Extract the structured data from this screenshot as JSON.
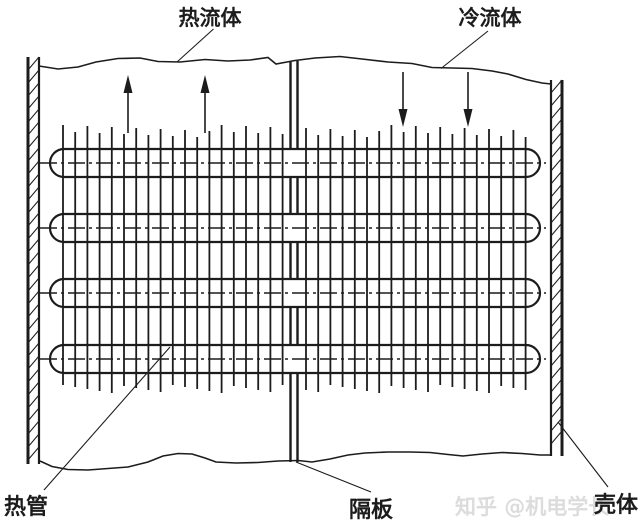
{
  "labels": {
    "hot_fluid": "热流体",
    "cold_fluid": "冷流体",
    "heat_pipe": "热管",
    "partition": "隔板",
    "shell": "壳体"
  },
  "watermark": {
    "text": "知乎 @机电学长"
  },
  "colors": {
    "line": "#1c1c1c",
    "background": "#ffffff",
    "watermark": "#d6d6d6"
  },
  "diagram": {
    "tubes": {
      "count": 4,
      "centers_y": [
        163,
        228,
        293,
        359
      ],
      "x_start": 50,
      "x_end": 540,
      "radius": 14
    },
    "fins": {
      "per_side": 19,
      "step": 12.2,
      "left_start_x": 63,
      "right_start_x": 306,
      "top_y": 131,
      "bottom_y": 389
    },
    "partition": {
      "x_center": 294,
      "line_gap": 7,
      "top_y": 61,
      "bottom_y": 462
    },
    "left_wall": {
      "x_outer": 28,
      "x_inner": 39,
      "top_y": 57,
      "bottom_y": 464
    },
    "right_wall": {
      "x_inner": 551,
      "x_outer": 562,
      "top_y": 80,
      "bottom_y": 456
    },
    "hatch_step": 13,
    "arrows": {
      "up_x": [
        128,
        205
      ],
      "up_top_y": 75,
      "up_bottom_y": 133,
      "down_x": [
        403,
        468
      ],
      "down_top_y": 72,
      "down_bottom_y": 127
    }
  }
}
